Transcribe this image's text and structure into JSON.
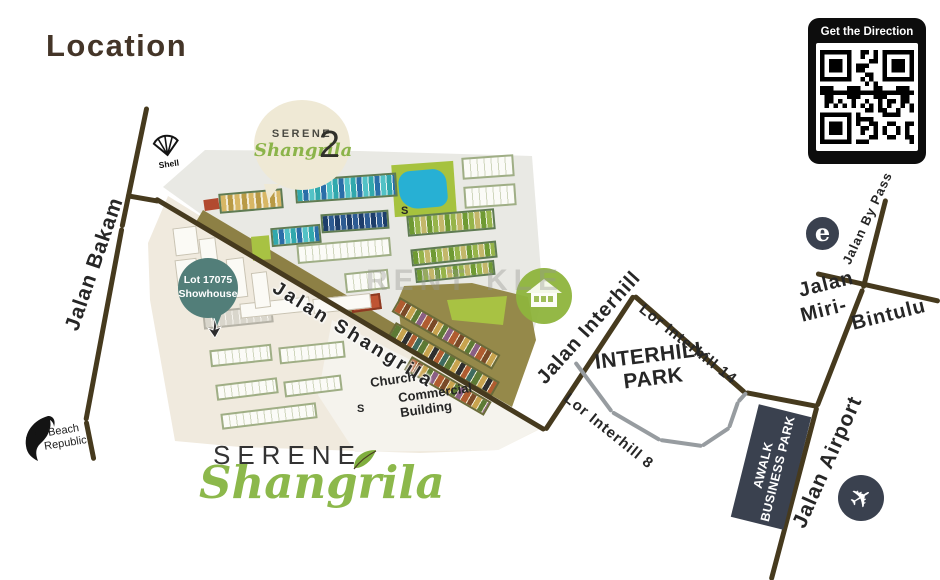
{
  "title": "Location",
  "qr": {
    "label": "Get the Direction"
  },
  "watermark": "RENT KLE",
  "roads": {
    "jalan_bakam": "Jalan Bakam",
    "jalan_shangrila": "Jalan Shangrila",
    "jalan_interhill": "Jalan Interhill",
    "lor_interhill_14": "Lor Interhill 14",
    "lor_interhill_8": "Lor Interhill 8",
    "jalan_by_pass": "Jalan By Pass",
    "jalan_miri_bintulu": [
      "Jalan",
      "Miri-",
      "Bintulu"
    ],
    "jalan_airport": "Jalan Airport"
  },
  "places": {
    "interhill_park": [
      "INTERHILL",
      "PARK"
    ],
    "awalk": [
      "AWALK",
      "BUSINESS PARK"
    ],
    "church": "Church",
    "commercial": [
      "Commercial",
      "Building"
    ],
    "showhouse": [
      "Lot 17075",
      "Showhouse"
    ],
    "s_marker": "S"
  },
  "logos": {
    "shell": "Shell",
    "beach": [
      "Beach",
      "Republic"
    ],
    "emart": "e",
    "serene2": {
      "line1": "SERENE",
      "line2": "Shangrila",
      "number": "2"
    },
    "main": {
      "line1": "SERENE",
      "line2": "Shangrila"
    }
  },
  "icons": {
    "plane": "✈"
  },
  "colors": {
    "road": "#463a1e",
    "accent_green": "#8cb84b",
    "slate": "#3a414f",
    "pool": "#27b0d4"
  }
}
